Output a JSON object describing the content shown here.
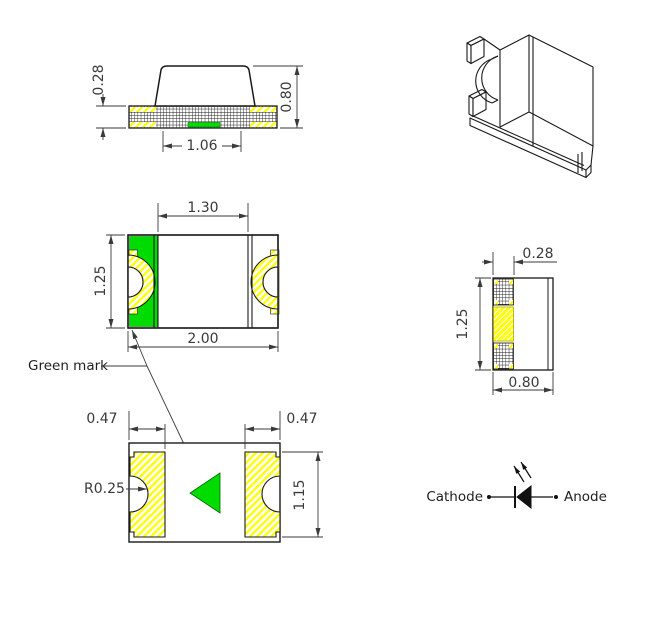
{
  "drawing": {
    "green_mark_label": "Green mark",
    "side_view": {
      "dim_terminal_height": "0.28",
      "dim_total_height": "0.80",
      "dim_bottom_width": "1.06"
    },
    "top_view": {
      "dim_inner_width": "1.30",
      "dim_body_height": "1.25",
      "dim_total_width": "2.00"
    },
    "end_view": {
      "dim_terminal_width": "0.28",
      "dim_body_height": "1.25",
      "dim_body_width": "0.80"
    },
    "bottom_view": {
      "dim_pad_width_left": "0.47",
      "dim_pad_width_right": "0.47",
      "dim_notch_radius": "R0.25",
      "dim_pad_height": "1.15"
    },
    "polarity_symbol": {
      "cathode_label": "Cathode",
      "anode_label": "Anode"
    }
  },
  "colors": {
    "green_mark": "#00dc00",
    "terminal_yellow": "#ffff00",
    "object_line": "#1a1a1a",
    "dimension_line": "#3a3a3a",
    "background": "#ffffff"
  }
}
